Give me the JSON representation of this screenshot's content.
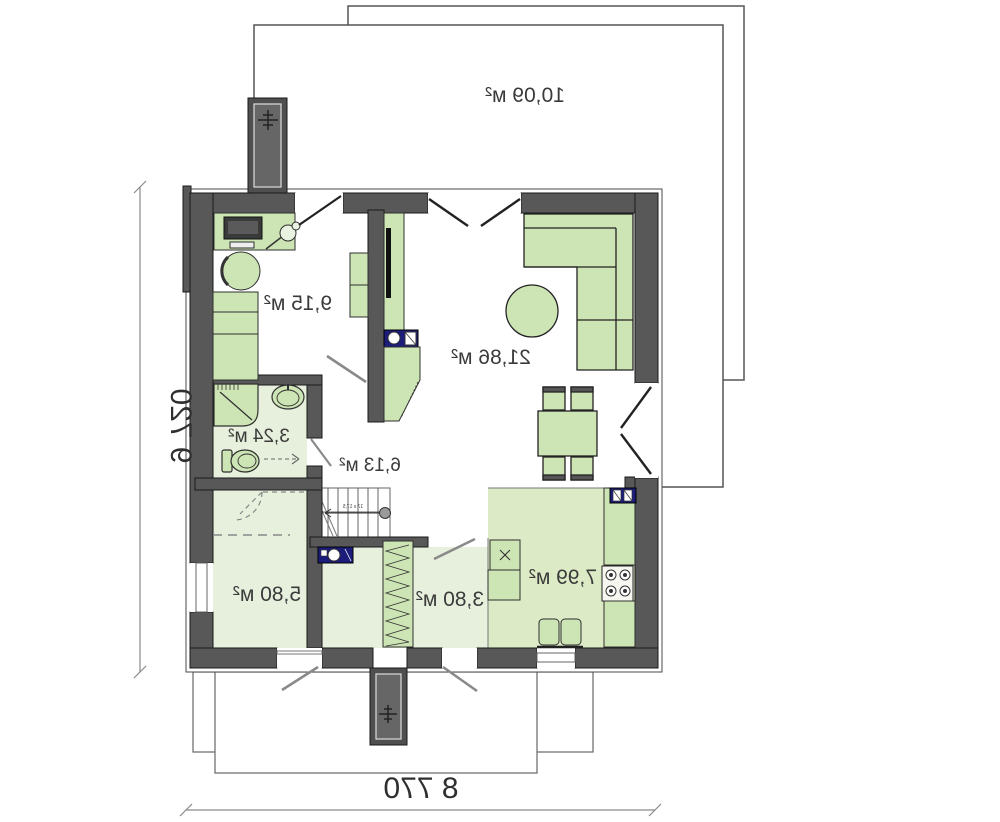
{
  "plan": {
    "type": "floor-plan-mirrored",
    "rooms": {
      "terrace": {
        "area": "10,09 м²"
      },
      "bedroom_top": {
        "area": "9,15 м²"
      },
      "living_room": {
        "area": "21,86 м²"
      },
      "bathroom": {
        "area": "3,24 м²"
      },
      "hall": {
        "area": "6,13 м²"
      },
      "bedroom_bottom": {
        "area": "5,80 м²"
      },
      "corridor": {
        "area": "3,80 м²"
      },
      "kitchen": {
        "area": "7,99 м²"
      }
    },
    "dimensions": {
      "width": "8 770",
      "height": "9 720"
    },
    "stairs": {
      "note": "17 x 17,5"
    },
    "colors": {
      "wall": "#585858",
      "furniture": "#cde4b5",
      "floor_light": "#e7f0dd",
      "floor_kitchen": "#ddeac6",
      "fixture_navy": "#1c1c7a",
      "dimension_line": "#8a8a8a"
    }
  }
}
